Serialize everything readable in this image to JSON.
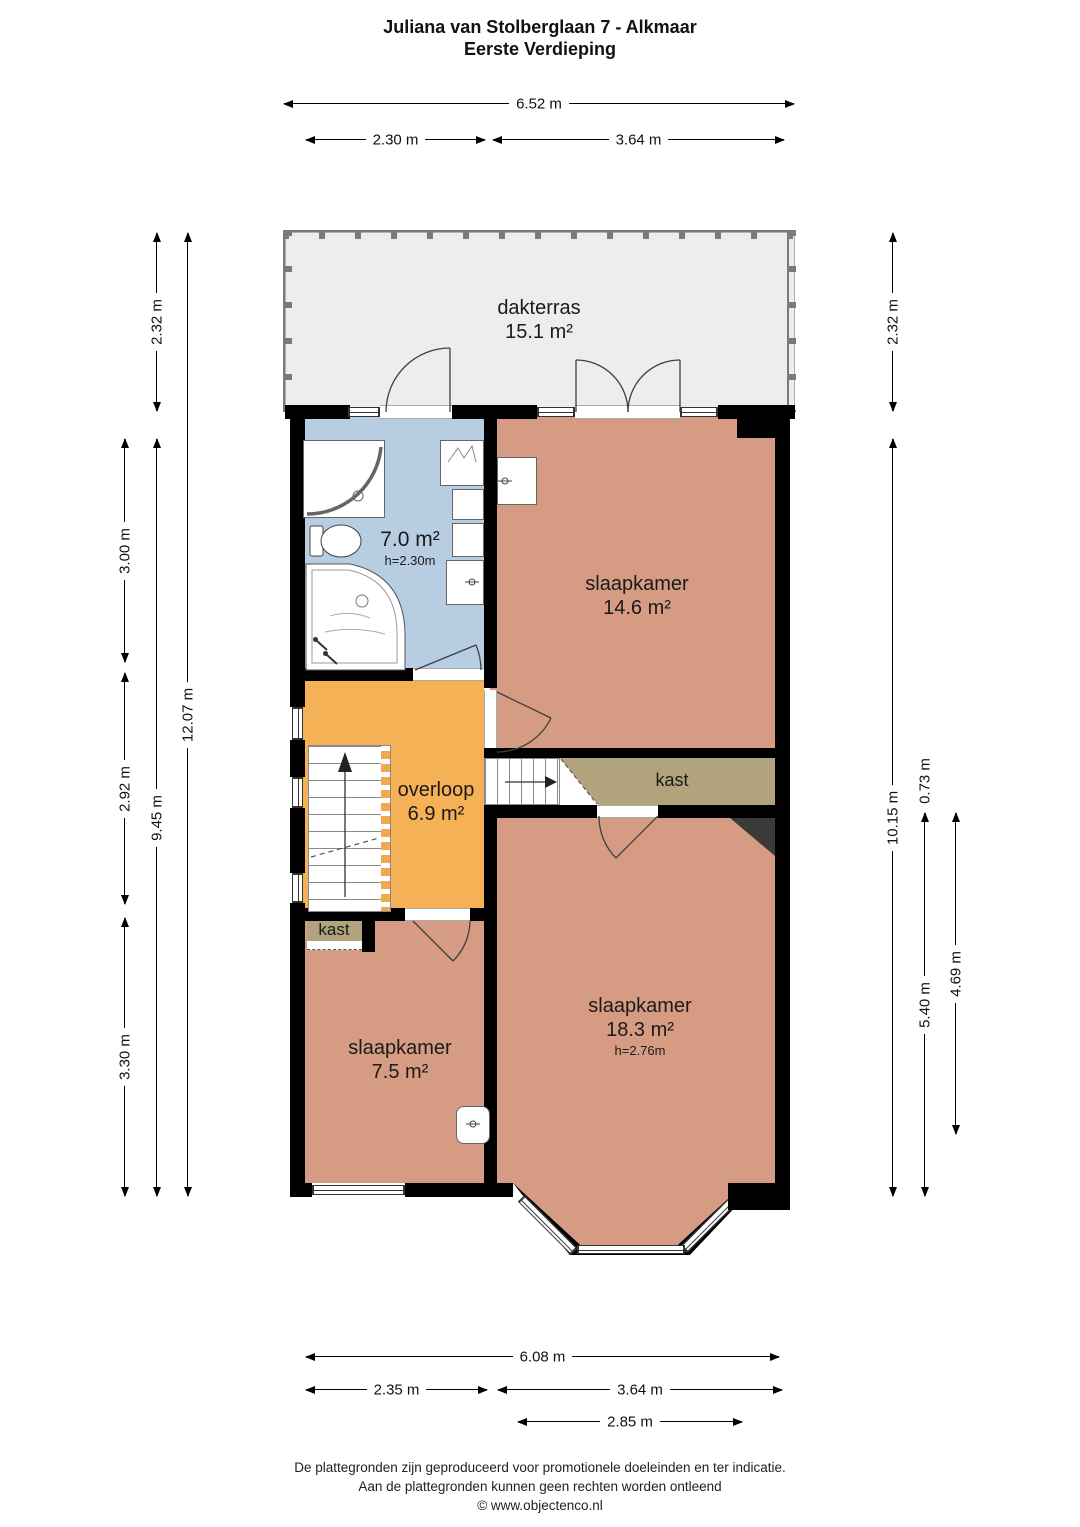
{
  "title": [
    "Juliana van Stolberglaan 7 - Alkmaar",
    "Eerste Verdieping"
  ],
  "rooms": {
    "dakterras": {
      "name": "dakterras",
      "area": "15.1 m²"
    },
    "badkamer": {
      "area": "7.0 m²",
      "height": "h=2.30m"
    },
    "slaapkamer1": {
      "name": "slaapkamer",
      "area": "14.6 m²"
    },
    "overloop": {
      "name": "overloop",
      "area": "6.9 m²"
    },
    "kast1": {
      "name": "kast"
    },
    "slaapkamer2": {
      "name": "slaapkamer",
      "area": "18.3 m²",
      "height": "h=2.76m"
    },
    "kast2": {
      "name": "kast"
    },
    "slaapkamer3": {
      "name": "slaapkamer",
      "area": "7.5 m²"
    }
  },
  "dimensions": {
    "top": [
      "6.52 m",
      "2.30 m",
      "3.64 m"
    ],
    "left": [
      "2.32 m",
      "3.00 m",
      "2.92 m",
      "3.30 m",
      "9.45 m",
      "12.07 m"
    ],
    "right": [
      "2.32 m",
      "10.15 m",
      "0.73 m",
      "5.40 m",
      "4.69 m"
    ],
    "bottom": [
      "6.08 m",
      "2.35 m",
      "3.64 m",
      "2.85 m"
    ]
  },
  "footer": [
    "De plattegronden zijn geproduceerd voor promotionele doeleinden en ter indicatie.",
    "Aan de plattegronden kunnen geen rechten worden ontleend",
    "© www.objectenco.nl"
  ],
  "colors": {
    "bedroom": "#d59c83",
    "bathroom": "#b7cde2",
    "landing": "#f5b156",
    "closet": "#b1a37b",
    "terrace": "#ededed",
    "wall": "#000000",
    "chimney": "#3b3b3b"
  }
}
